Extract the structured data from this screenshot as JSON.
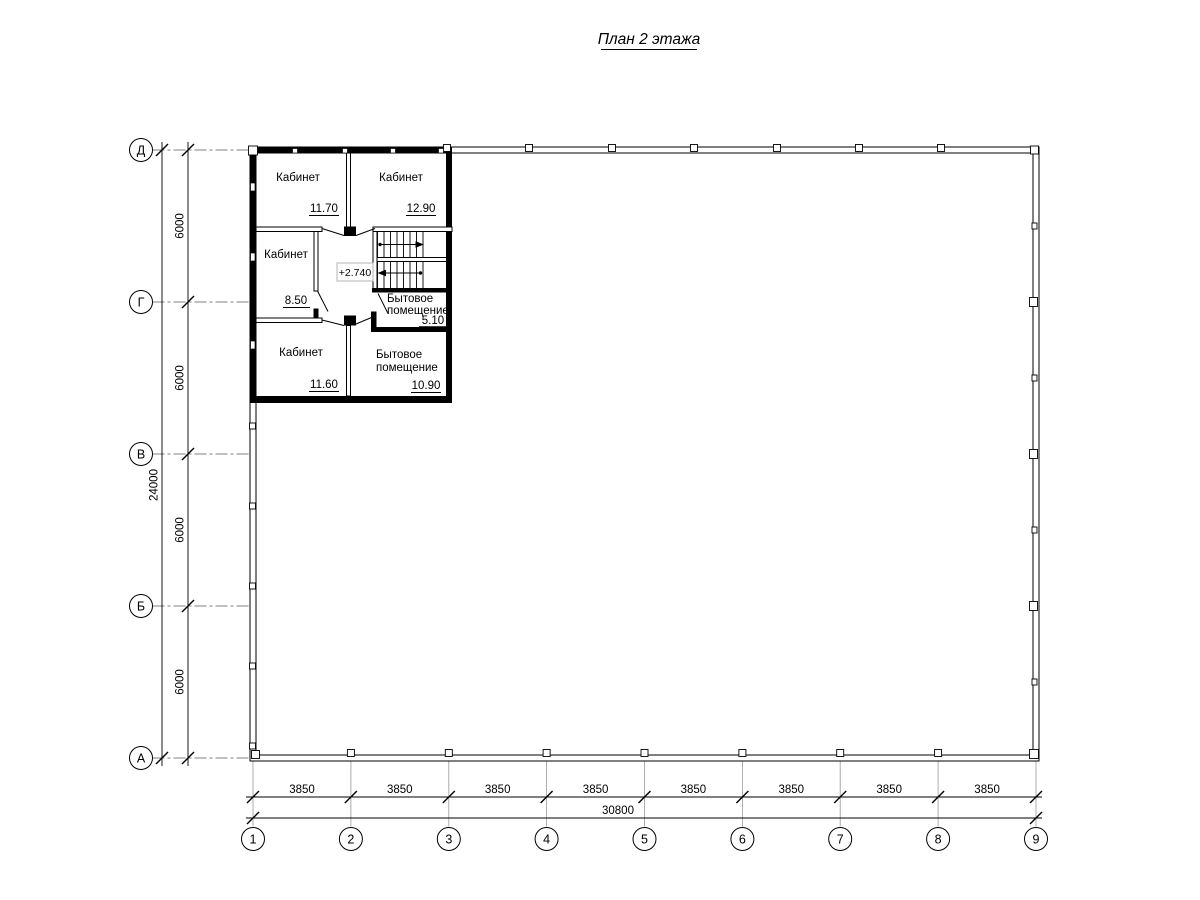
{
  "title": "План 2 этажа",
  "plan": {
    "elevation_label": "+2.740",
    "rooms": [
      {
        "name": "Кабинет",
        "area": "11.70"
      },
      {
        "name": "Кабинет",
        "area": "12.90"
      },
      {
        "name": "Кабинет",
        "area": "8.50"
      },
      {
        "name": "Кабинет",
        "area": "11.60"
      },
      {
        "name_line1": "Бытовое",
        "name_line2": "помещение",
        "area": "5.10"
      },
      {
        "name_line1": "Бытовое",
        "name_line2": "помещение",
        "area": "10.90"
      }
    ]
  },
  "grid": {
    "row_labels": [
      "Д",
      "Г",
      "В",
      "Б",
      "А"
    ],
    "col_labels": [
      "1",
      "2",
      "3",
      "4",
      "5",
      "6",
      "7",
      "8",
      "9"
    ]
  },
  "dimensions": {
    "left": {
      "segments": [
        "6000",
        "6000",
        "6000",
        "6000"
      ],
      "overall": "24000"
    },
    "bottom": {
      "segments": [
        "3850",
        "3850",
        "3850",
        "3850",
        "3850",
        "3850",
        "3850",
        "3850"
      ],
      "overall": "30800"
    }
  },
  "colors": {
    "line": "#000000",
    "background": "#ffffff"
  }
}
